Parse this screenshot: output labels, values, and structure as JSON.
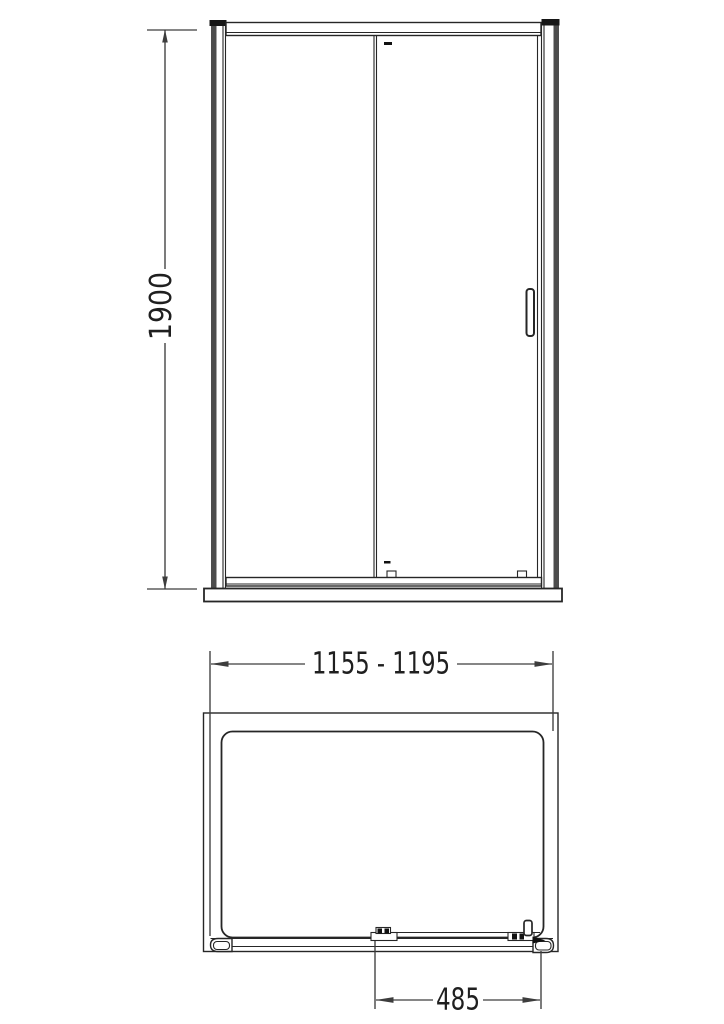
{
  "diagram": {
    "type": "technical-drawing",
    "views": {
      "front_elevation": {
        "components": [
          "left-wall-profile",
          "right-wall-profile",
          "top-rail",
          "bottom-rail",
          "fixed-panel",
          "sliding-panel",
          "door-handle",
          "roller-covers",
          "shower-tray"
        ]
      },
      "plan": {
        "components": [
          "tray-outline",
          "tray-inner-edge",
          "bottom-track",
          "track-end-caps",
          "sliding-panel",
          "roller-brackets",
          "door-handle"
        ]
      }
    },
    "dimensions": {
      "height": {
        "label": "1900",
        "orientation": "vertical"
      },
      "width": {
        "label": "1155 - 1195",
        "orientation": "horizontal"
      },
      "opening": {
        "label": "485",
        "orientation": "horizontal"
      }
    },
    "colors": {
      "background": "#ffffff",
      "line": "#262626",
      "dimension_line": "#3d3d3d",
      "profile_gray": "#4d4d4d",
      "cap_black": "#161616",
      "detail_black": "#111111",
      "text": "#1f1f1f"
    }
  }
}
